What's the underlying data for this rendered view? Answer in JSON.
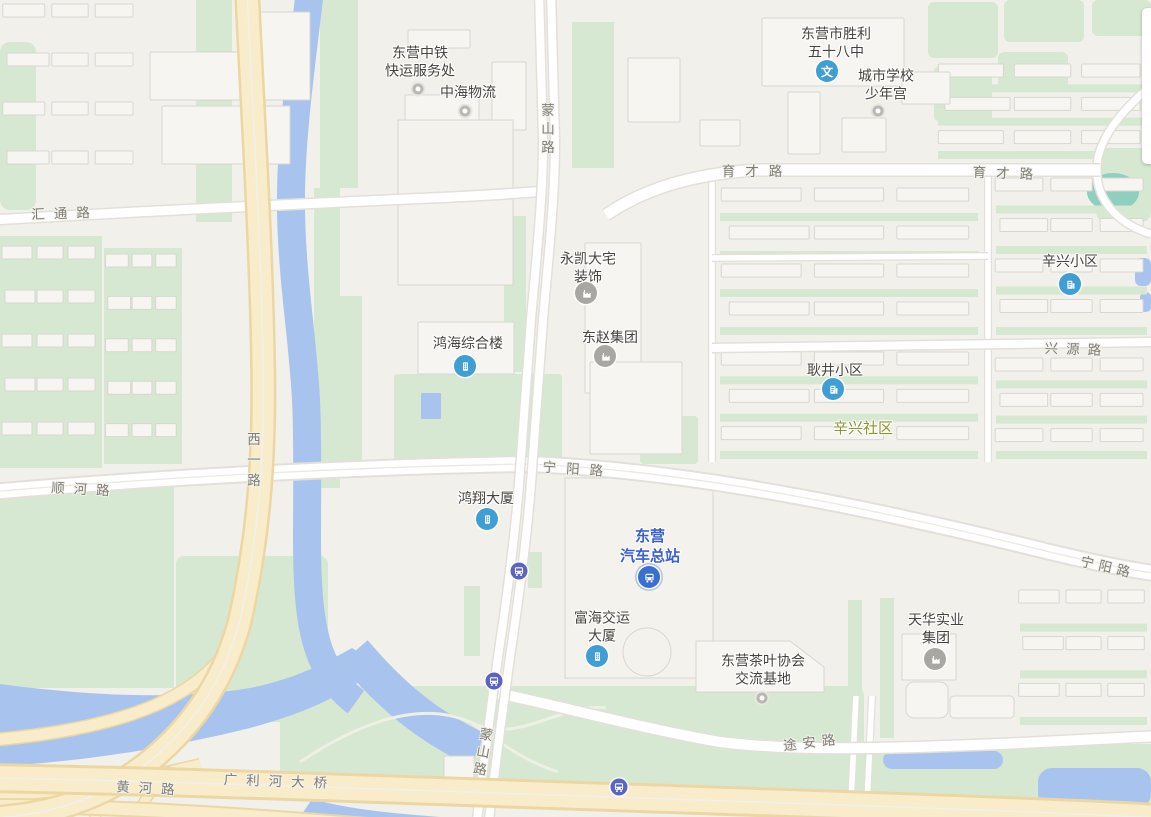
{
  "map": {
    "colors": {
      "background": "#f2f0eb",
      "park_green": "#d6e8d1",
      "water_blue": "#a8c4ee",
      "pond_teal": "#8fcfc0",
      "road_fill": "#ffffff",
      "road_casing": "#e2e0d9",
      "highway_fill": "#f9ecca",
      "highway_casing": "#ecd7a4",
      "building_fill": "#f7f5f1",
      "building_stroke": "#d8d6cf",
      "poi_text": "#45433e",
      "road_text": "#7f7d75",
      "transit_text_blue": "#3a5fd0",
      "district_text_olive": "#8f9430",
      "poi_icon_blue": "#3f9fd4",
      "poi_icon_gray": "#a9a7a1",
      "bus_station_blue": "#3a6ed0",
      "bus_stop_indigo": "#5c64c2"
    },
    "pois": [
      {
        "id": "zhongtie-express",
        "lines": [
          "东营中铁",
          "快运服务处"
        ],
        "x": 420,
        "y": 62,
        "color": "default",
        "icon": {
          "type": "dot",
          "x": 418,
          "y": 89
        }
      },
      {
        "id": "zhonghai-logistics",
        "lines": [
          "中海物流"
        ],
        "x": 468,
        "y": 92,
        "color": "default",
        "icon": {
          "type": "dot",
          "x": 465,
          "y": 111
        }
      },
      {
        "id": "shengli-58-school",
        "lines": [
          "东营市胜利",
          "五十八中"
        ],
        "x": 836,
        "y": 43,
        "color": "default",
        "icon": {
          "type": "school",
          "x": 827,
          "y": 71,
          "glyph": "文"
        }
      },
      {
        "id": "city-youth-palace",
        "lines": [
          "城市学校",
          "少年宫"
        ],
        "x": 886,
        "y": 85,
        "color": "default",
        "icon": {
          "type": "dot",
          "x": 878,
          "y": 111
        }
      },
      {
        "id": "yongkai-decoration",
        "lines": [
          "永凯大宅",
          "装饰"
        ],
        "x": 588,
        "y": 268,
        "color": "default",
        "icon": {
          "type": "factory",
          "x": 586,
          "y": 293
        }
      },
      {
        "id": "dongzhao-group",
        "lines": [
          "东赵集团"
        ],
        "x": 610,
        "y": 337,
        "color": "default",
        "icon": {
          "type": "factory",
          "x": 605,
          "y": 356
        }
      },
      {
        "id": "honghai-complex",
        "lines": [
          "鸿海综合楼"
        ],
        "x": 468,
        "y": 343,
        "color": "default",
        "icon": {
          "type": "building",
          "x": 465,
          "y": 366
        }
      },
      {
        "id": "xinxing-residential",
        "lines": [
          "辛兴小区"
        ],
        "x": 1070,
        "y": 261,
        "color": "default",
        "icon": {
          "type": "residential",
          "x": 1070,
          "y": 284
        }
      },
      {
        "id": "gengjing-residential",
        "lines": [
          "耿井小区"
        ],
        "x": 835,
        "y": 370,
        "color": "default",
        "icon": {
          "type": "residential",
          "x": 833,
          "y": 389
        }
      },
      {
        "id": "xinxing-community",
        "lines": [
          "辛兴社区"
        ],
        "x": 863,
        "y": 429,
        "color": "olive",
        "icon": null
      },
      {
        "id": "hongxiang-tower",
        "lines": [
          "鸿翔大厦"
        ],
        "x": 486,
        "y": 498,
        "color": "default",
        "icon": {
          "type": "building",
          "x": 487,
          "y": 519
        }
      },
      {
        "id": "dongying-bus-terminal",
        "lines": [
          "东营",
          "汽车总站"
        ],
        "x": 650,
        "y": 547,
        "color": "blue",
        "icon": {
          "type": "bus-station",
          "x": 649,
          "y": 577
        }
      },
      {
        "id": "fuhai-jiaoyun-tower",
        "lines": [
          "富海交运",
          "大厦"
        ],
        "x": 602,
        "y": 627,
        "color": "default",
        "icon": {
          "type": "building",
          "x": 597,
          "y": 656
        }
      },
      {
        "id": "tea-association-base",
        "lines": [
          "东营茶叶协会",
          "交流基地"
        ],
        "x": 763,
        "y": 670,
        "color": "default",
        "icon": {
          "type": "dot",
          "x": 762,
          "y": 698
        }
      },
      {
        "id": "tianhua-industrial",
        "lines": [
          "天华实业",
          "集团"
        ],
        "x": 936,
        "y": 629,
        "color": "default",
        "icon": {
          "type": "factory",
          "x": 935,
          "y": 659
        }
      },
      {
        "id": "bus-stop-1",
        "lines": [],
        "x": 519,
        "y": 571,
        "color": "default",
        "icon": {
          "type": "bus-stop",
          "x": 519,
          "y": 571
        }
      },
      {
        "id": "bus-stop-2",
        "lines": [],
        "x": 494,
        "y": 681,
        "color": "default",
        "icon": {
          "type": "bus-stop",
          "x": 494,
          "y": 681
        }
      },
      {
        "id": "bus-stop-3",
        "lines": [],
        "x": 619,
        "y": 787,
        "color": "default",
        "icon": {
          "type": "bus-stop",
          "x": 619,
          "y": 787
        }
      }
    ],
    "road_labels": [
      {
        "id": "mengshan-rd-top",
        "text": "蒙山路",
        "x": 546,
        "y": 131,
        "vertical": true,
        "rotate": 0,
        "spacing": 5
      },
      {
        "id": "mengshan-rd-bottom",
        "text": "蒙山路",
        "x": 481,
        "y": 753,
        "vertical": true,
        "rotate": 10,
        "spacing": 4
      },
      {
        "id": "yucai-rd-west",
        "text": "育才路",
        "x": 757,
        "y": 170,
        "vertical": false,
        "rotate": 0,
        "spacing": 10
      },
      {
        "id": "yucai-rd-east",
        "text": "育才路",
        "x": 1008,
        "y": 172,
        "vertical": false,
        "rotate": 2,
        "spacing": 10
      },
      {
        "id": "huitong-rd",
        "text": "汇通路",
        "x": 65,
        "y": 212,
        "vertical": false,
        "rotate": -2,
        "spacing": 9
      },
      {
        "id": "xiyi-rd",
        "text": "西一路",
        "x": 252,
        "y": 463,
        "vertical": true,
        "rotate": 0,
        "spacing": 7
      },
      {
        "id": "shunhe-rd",
        "text": "顺河路",
        "x": 85,
        "y": 488,
        "vertical": false,
        "rotate": 3,
        "spacing": 9
      },
      {
        "id": "ningyang-rd-west",
        "text": "宁阳路",
        "x": 578,
        "y": 468,
        "vertical": false,
        "rotate": 4,
        "spacing": 10
      },
      {
        "id": "ningyang-rd-east",
        "text": "宁阳路",
        "x": 1108,
        "y": 566,
        "vertical": false,
        "rotate": 13,
        "spacing": 5
      },
      {
        "id": "xingyuan-rd",
        "text": "兴源路",
        "x": 1077,
        "y": 348,
        "vertical": false,
        "rotate": 2,
        "spacing": 8
      },
      {
        "id": "tuan-rd",
        "text": "途安路",
        "x": 812,
        "y": 741,
        "vertical": false,
        "rotate": -7,
        "spacing": 6
      },
      {
        "id": "huanghe-rd",
        "text": "黄河路",
        "x": 150,
        "y": 787,
        "vertical": false,
        "rotate": 3,
        "spacing": 9
      },
      {
        "id": "guanglihe-bridge",
        "text": "广利河大桥",
        "x": 280,
        "y": 780,
        "vertical": false,
        "rotate": 2,
        "spacing": 9
      }
    ]
  }
}
